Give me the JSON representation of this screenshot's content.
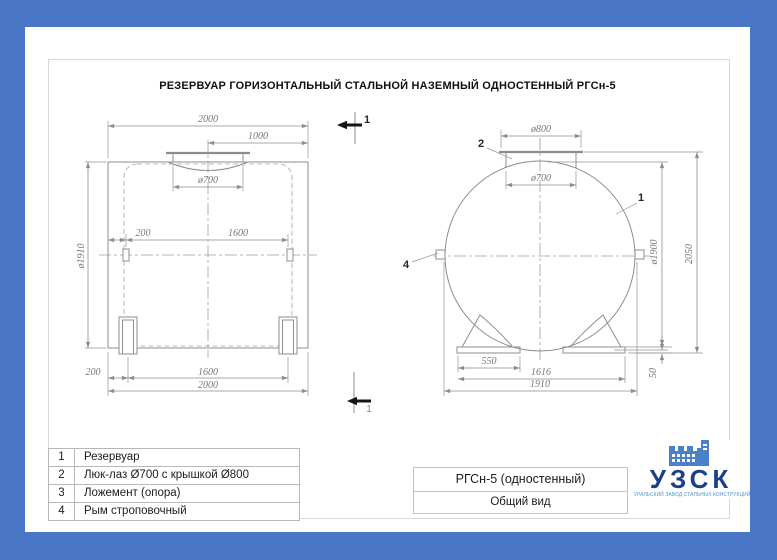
{
  "colors": {
    "border_blue": "#4a77c5",
    "sheet_white": "#ffffff",
    "line_gray": "#8d8d8d",
    "logo_navy": "#1c3f87",
    "logo_blue": "#4a82ca"
  },
  "title": "РЕЗЕРВУАР ГОРИЗОНТАЛЬНЫЙ СТАЛЬНОЙ НАЗЕМНЫЙ ОДНОСТЕННЫЙ РГСн-5",
  "section_mark": {
    "label": "1"
  },
  "side_view": {
    "dims": {
      "length_top": "2000",
      "manhole_to_end": "1000",
      "manhole_dia": "ø700",
      "lug_offset": "200",
      "lug_spacing": "1600",
      "shell_dia": "ø1910",
      "support_offset": "200",
      "support_spacing": "1600",
      "length_bottom": "2000"
    }
  },
  "end_view": {
    "dims": {
      "cover_dia": "ø800",
      "manhole_dia": "ø700",
      "shell_dia": "ø1900",
      "overall_height": "2050",
      "support_width": "550",
      "support_spacing": "1616",
      "overall_width": "1910",
      "bottom_gap": "50"
    },
    "callouts": {
      "tank": "1",
      "manhole": "2",
      "lug": "4"
    }
  },
  "parts_table": {
    "rows": [
      {
        "num": "1",
        "name": "Резервуар"
      },
      {
        "num": "2",
        "name": "Люк-лаз Ø700 с крышкой Ø800"
      },
      {
        "num": "3",
        "name": "Ложемент (опора)"
      },
      {
        "num": "4",
        "name": "Рым строповочный"
      }
    ]
  },
  "title_block": {
    "model": "РГСн-5 (одностенный)",
    "view": "Общий вид"
  },
  "logo": {
    "abbr": "УЗСК",
    "tagline": "УРАЛЬСКИЙ ЗАВОД СТАЛЬНЫХ КОНСТРУКЦИЙ"
  }
}
